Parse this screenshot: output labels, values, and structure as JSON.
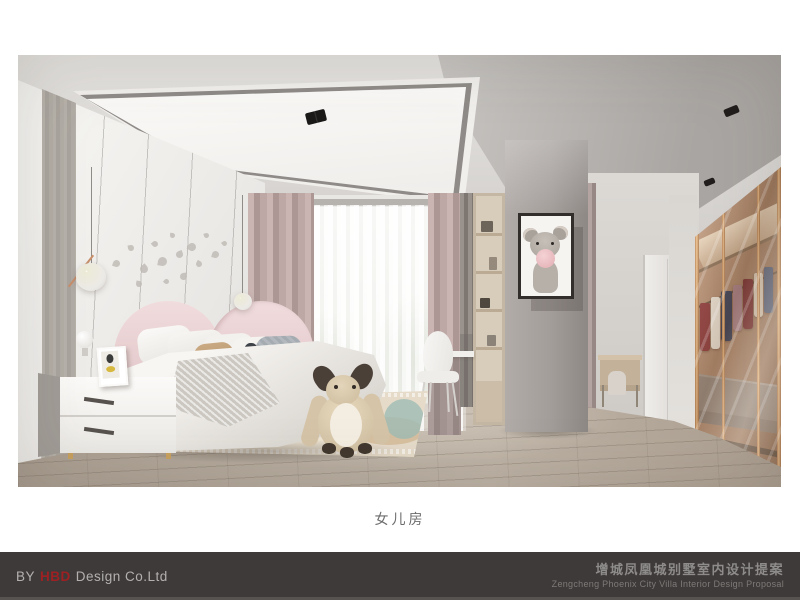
{
  "caption": "女儿房",
  "footer": {
    "by": "BY",
    "brand": "HBD",
    "company": "Design Co.Ltd",
    "title_cn": "增城凤凰城别墅室内设计提案",
    "title_en": "Zengcheng Phoenix City Villa Interior Design Proposal"
  },
  "colors": {
    "accent_red": "#9e2022",
    "footer_bg": "#3e3a39",
    "footer_text": "#b3b1af",
    "footer_title": "#8e8c8a",
    "caption_text": "#6c6c6c",
    "headboard_pink": "#ecd5d6",
    "wardrobe_copper": "#cf9a6e",
    "rug_teal": "#a9c4ba"
  }
}
